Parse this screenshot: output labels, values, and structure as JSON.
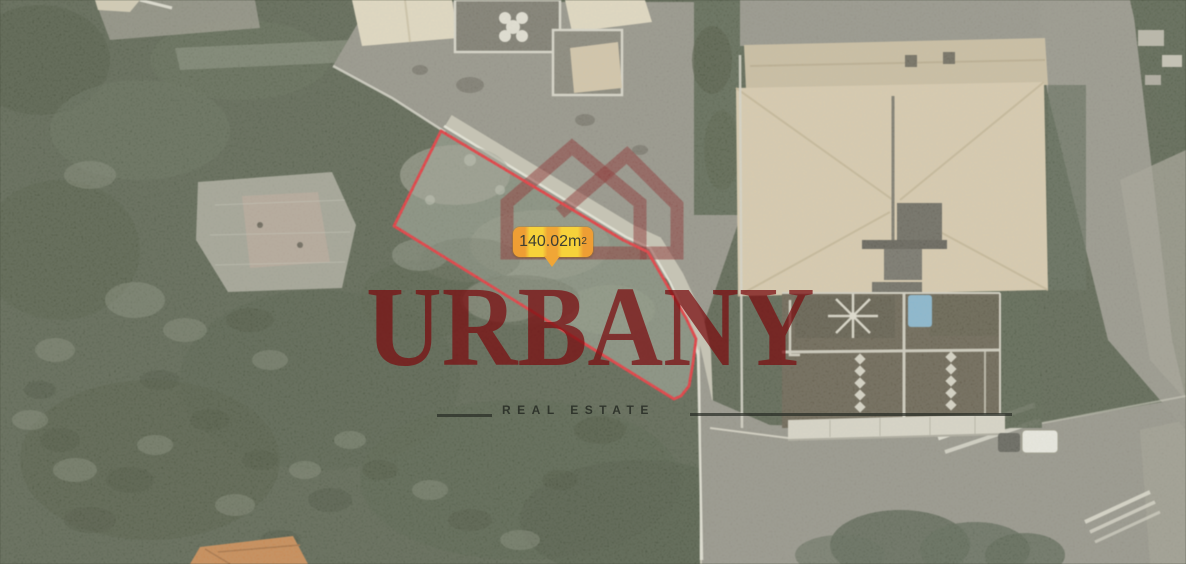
{
  "map": {
    "type": "satellite-aerial-photo",
    "parcel": {
      "boundary_color": "#e81b24",
      "area_label": {
        "value": "140.02",
        "unit": " m",
        "exponent": "2",
        "bg_yellow": "#f7d23a",
        "bg_orange": "#ee9e34"
      }
    },
    "watermark": {
      "brand": "URBANY",
      "tagline": "REAL ESTATE",
      "brand_color": "#7a0e10",
      "logo_icon": "double-house-outline"
    }
  }
}
